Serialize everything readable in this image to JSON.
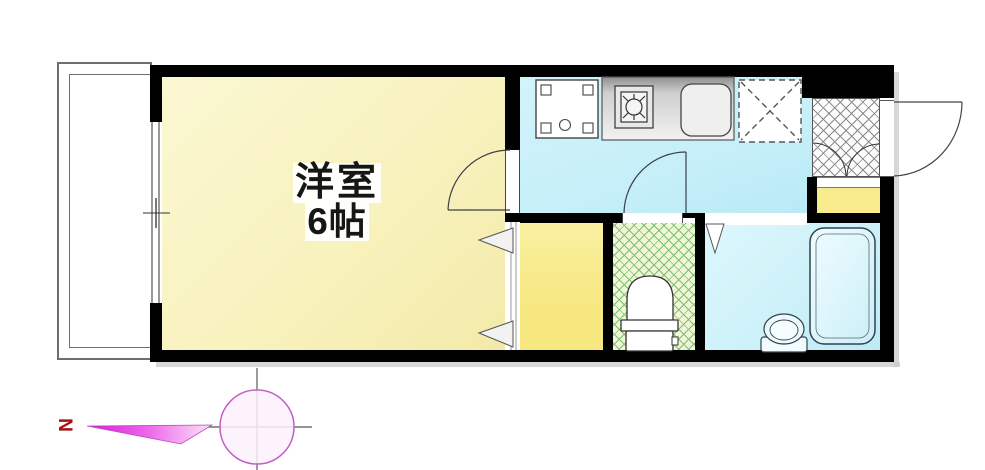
{
  "floorplan": {
    "main_room": {
      "name": "洋室",
      "size": "6帖"
    },
    "compass": {
      "north": "N"
    },
    "rooms": [
      "western-room",
      "kitchen",
      "closet",
      "toilet-room",
      "bathroom",
      "entrance",
      "shoe-cabinet",
      "balcony"
    ],
    "fixtures": [
      "washing-machine",
      "gas-stove",
      "kitchen-sink",
      "kitchen-counter",
      "refrigerator-space",
      "toilet",
      "bathtub",
      "washbasin",
      "entry-door",
      "room-door",
      "toilet-door",
      "bathroom-door-marker",
      "closet-folding-doors",
      "sliding-window",
      "compass-rose"
    ],
    "colors": {
      "main_room_fill": "#F8F2BE",
      "kitchen_fill": "#C6EFF9",
      "closet_fill": "#F6E77E",
      "cabinet_fill": "#F8EB8D",
      "bathroom_fill": "#CDF1F9",
      "toilet_fill": "#F1F6D8",
      "toilet_lattice": "#79C26B",
      "tile_line": "#8A8A8A",
      "wall": "#000000",
      "door_line": "#3A4048",
      "compass_arrow": "#E11BE1",
      "compass_circle": "#C45FC4",
      "north_color": "#A51212"
    }
  }
}
